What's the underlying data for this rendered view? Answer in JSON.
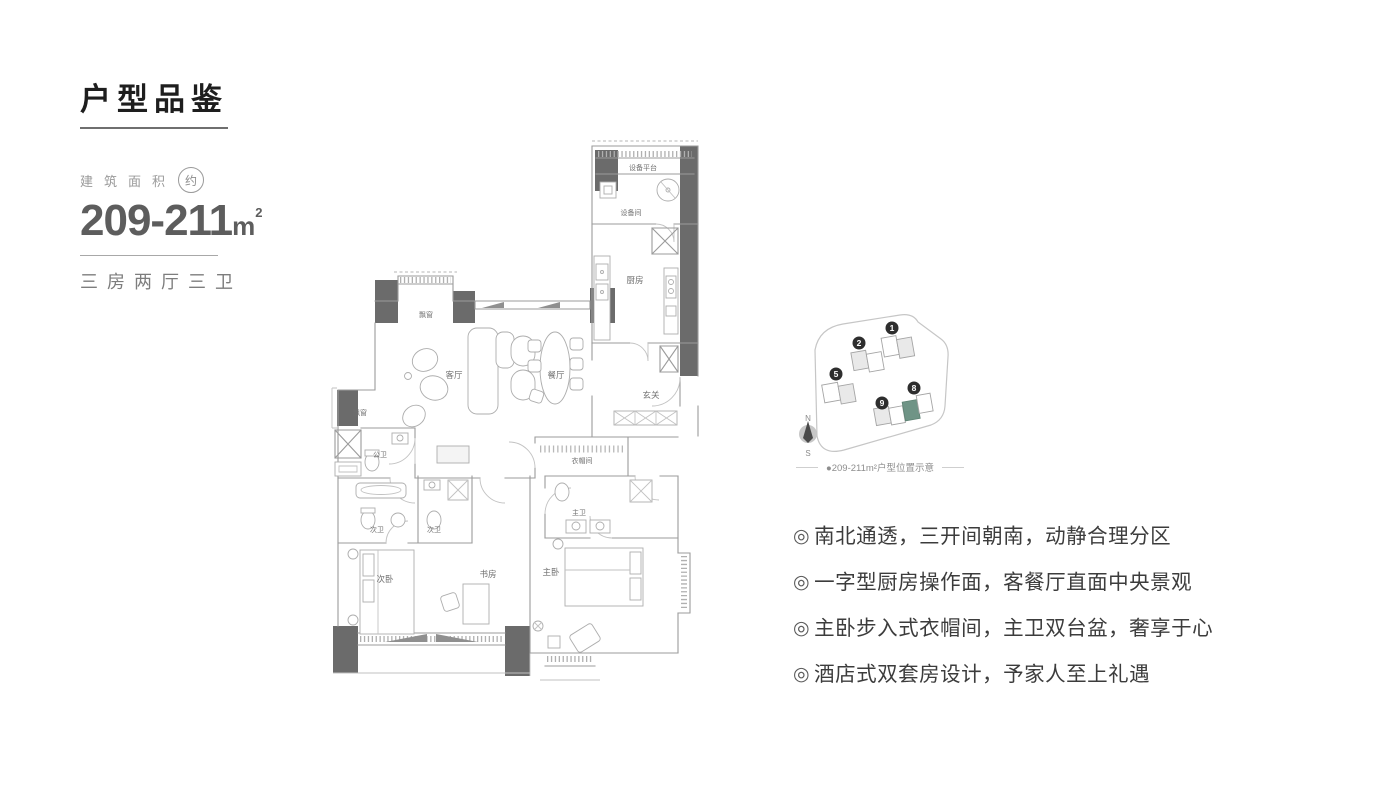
{
  "header": {
    "title": "户型品鉴"
  },
  "area": {
    "label": "建筑面积",
    "approx": "约",
    "value": "209-211",
    "unit": "m",
    "unit_sup": "2",
    "layout": "三房两厅三卫"
  },
  "floorplan": {
    "rooms": {
      "equipment_platform": "设备平台",
      "equipment_room": "设备间",
      "kitchen": "厨房",
      "bay_window": "飘窗",
      "living_room": "客厅",
      "dining_room": "餐厅",
      "foyer": "玄关",
      "cloakroom": "衣帽间",
      "guest_bath": "公卫",
      "second_bath": "次卫",
      "second_bedroom": "次卧",
      "study": "书房",
      "master_bedroom": "主卧",
      "master_bath": "主卫"
    },
    "wall_color": "#6b6b6b",
    "line_color": "#9b9b9b"
  },
  "siteplan": {
    "buildings": [
      {
        "num": "1"
      },
      {
        "num": "2"
      },
      {
        "num": "5"
      },
      {
        "num": "8"
      },
      {
        "num": "9"
      }
    ],
    "highlight_color": "#6F9486",
    "compass": {
      "north": "N",
      "south": "S"
    },
    "caption": "●209-211m²户型位置示意"
  },
  "features": {
    "marker": "◎",
    "items": [
      "南北通透，三开间朝南，动静合理分区",
      "一字型厨房操作面，客餐厅直面中央景观",
      "主卧步入式衣帽间，主卫双台盆，奢享于心",
      "酒店式双套房设计，予家人至上礼遇"
    ]
  }
}
